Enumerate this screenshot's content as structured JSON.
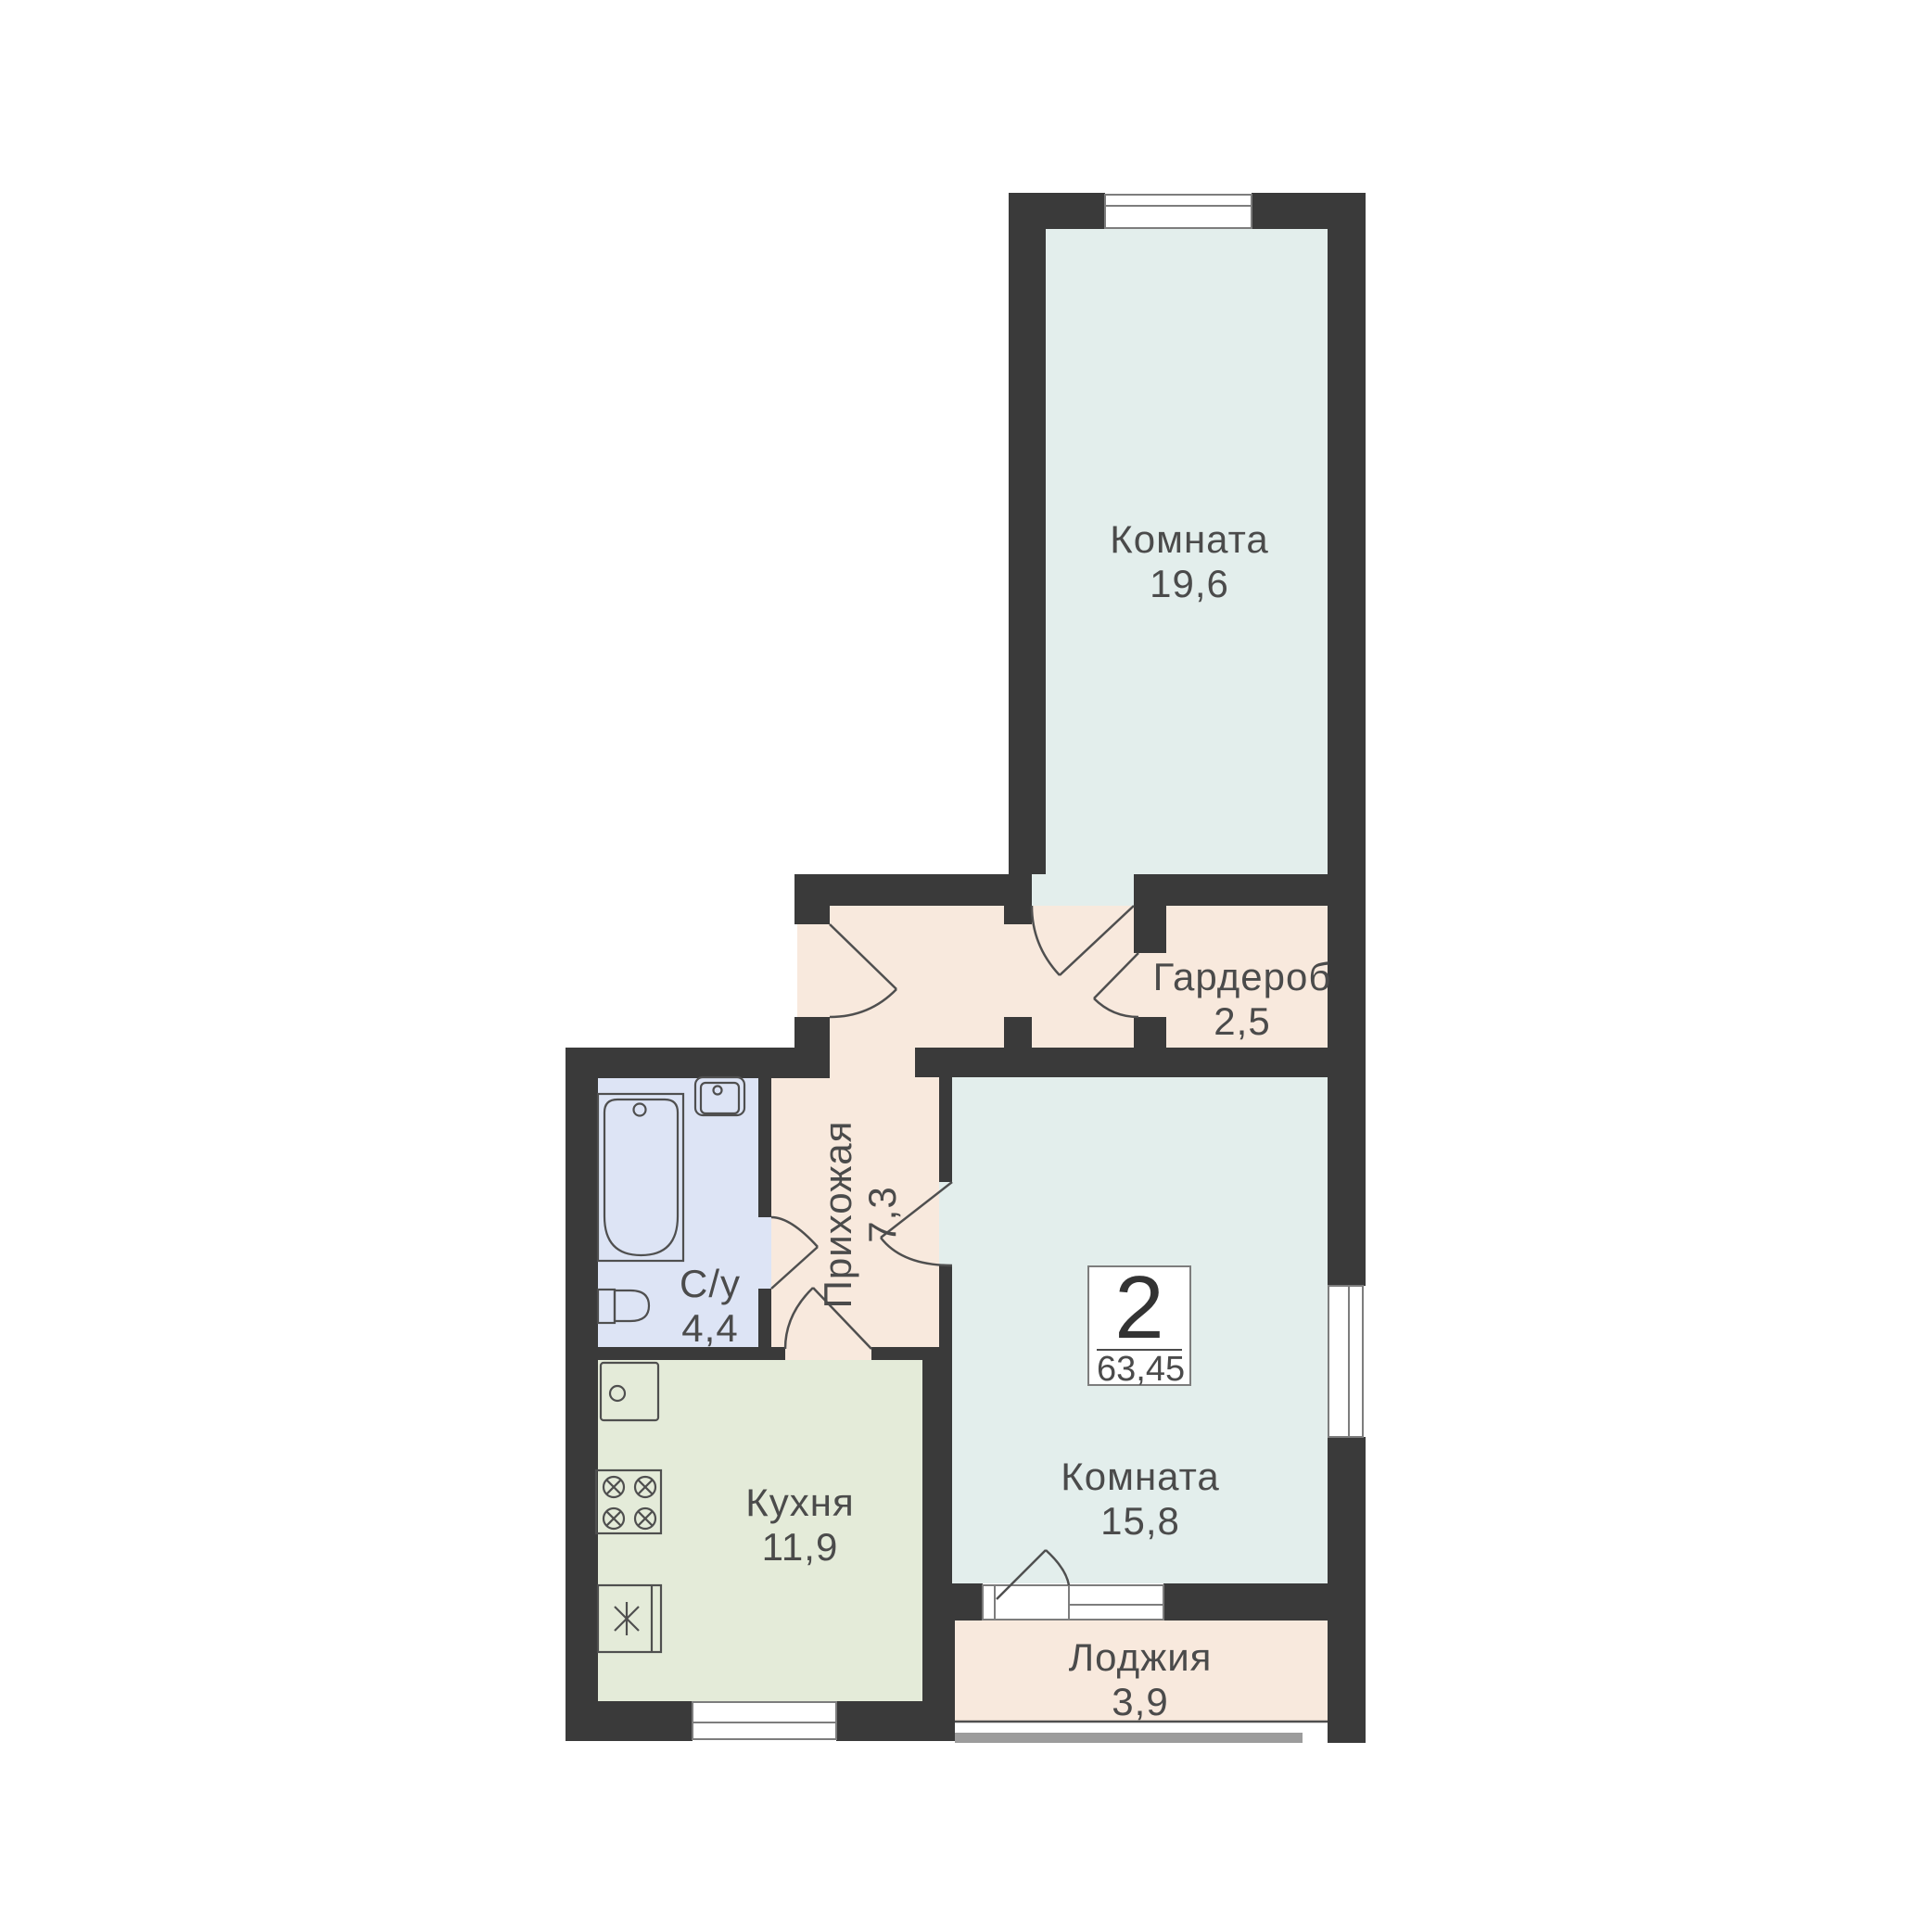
{
  "title": "2-room apartment floor plan",
  "badge": {
    "rooms": "2",
    "area": "63,45"
  },
  "rooms": {
    "room_top": {
      "name": "Комната",
      "area": "19,6"
    },
    "wardrobe": {
      "name": "Гардероб",
      "area": "2,5"
    },
    "hallway": {
      "name": "Прихожая",
      "area": "7,3"
    },
    "bathroom": {
      "name": "С/у",
      "area": "4,4"
    },
    "kitchen": {
      "name": "Кухня",
      "area": "11,9"
    },
    "room_main": {
      "name": "Комната",
      "area": "15,8"
    },
    "loggia": {
      "name": "Лоджия",
      "area": "3,9"
    }
  },
  "fixtures": [
    "bathtub",
    "sink",
    "toilet",
    "kitchen-sink",
    "stove-4-burners",
    "fridge-freezer"
  ],
  "colors": {
    "wall": "#3a3a3a",
    "room": "#e3eeec",
    "hall": "#f8e9dd",
    "bath": "#dde4f5",
    "kitchen": "#e4ebd9",
    "text": "#4b4b4b",
    "line": "#4f4f4f",
    "frame": "#7d7d7d",
    "rail": "#9c9c9c"
  }
}
